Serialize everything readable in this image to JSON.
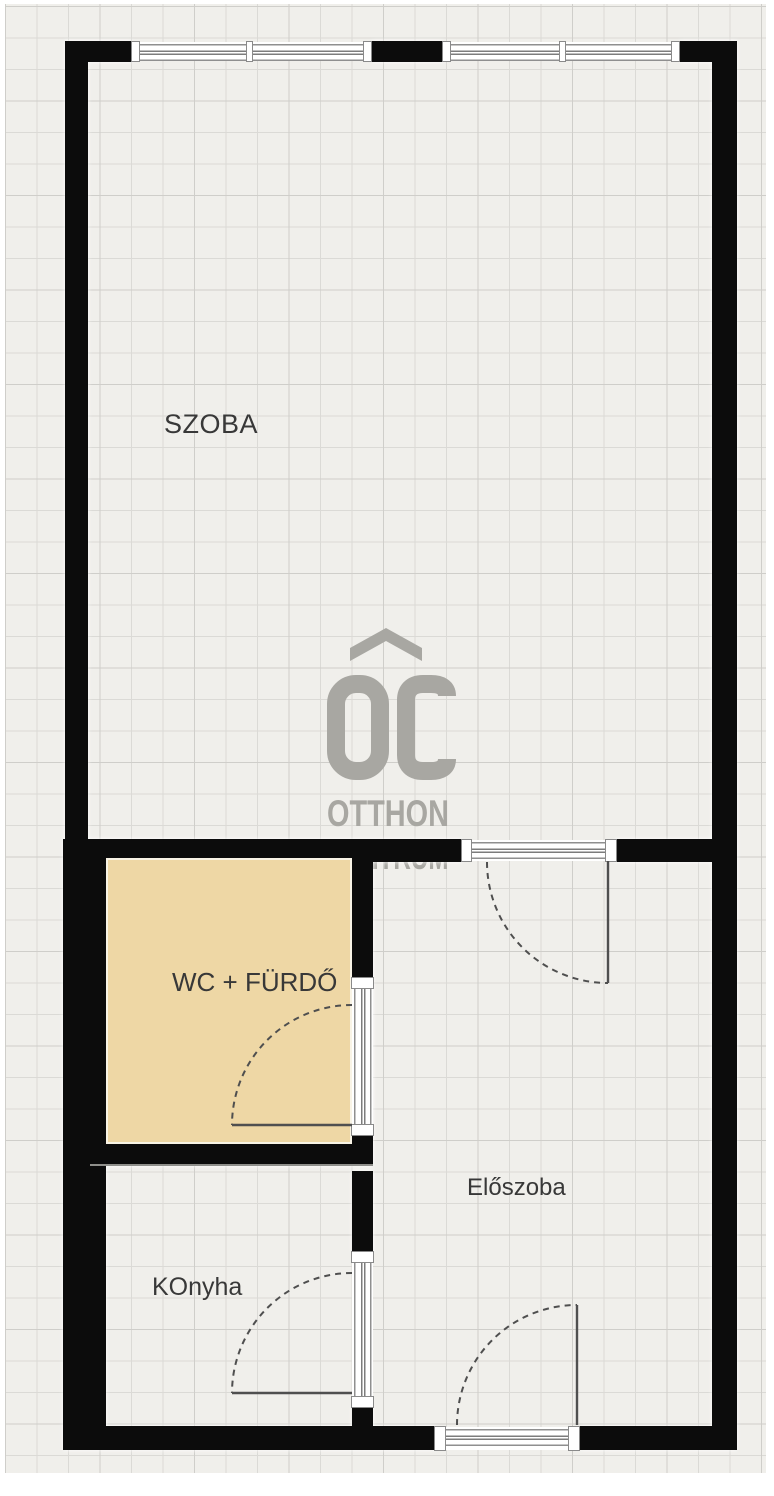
{
  "floorplan": {
    "rooms": [
      {
        "id": "szoba",
        "label": "SZOBA"
      },
      {
        "id": "wc-furdo",
        "label": "WC + FÜRDŐ"
      },
      {
        "id": "eloszoba",
        "label": "Előszoba"
      },
      {
        "id": "konyha",
        "label": "KOnyha"
      }
    ],
    "watermark": {
      "monogram": "OC",
      "name_line1": "OTTHON",
      "name_line2": "CENTRUM"
    },
    "colors": {
      "wall": "#0c0c0c",
      "canvas": "#f0efeb",
      "grid_line": "#dbdad6",
      "bathroom_fill": "#eed7a5",
      "watermark_gray": "#a8a7a2",
      "label_text": "#383838"
    }
  }
}
